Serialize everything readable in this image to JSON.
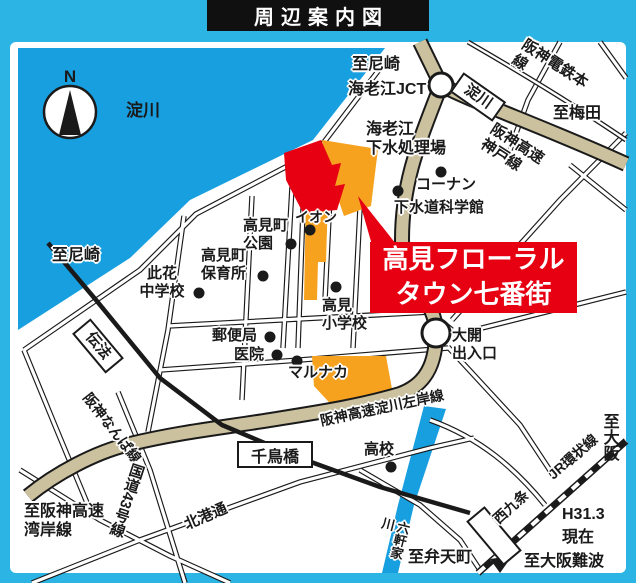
{
  "title": "周辺案内図",
  "colors": {
    "frame": "#2bb4e4",
    "water": "#189fe0",
    "expressway": "#cbc19e",
    "site_red": "#e60012",
    "building_orange": "#f6a21f",
    "ink": "#1a1a1a"
  },
  "compass": {
    "north": "N"
  },
  "rivers": {
    "yodogawa": "淀川",
    "rokkenya": "六軒家川"
  },
  "site": {
    "name": "高見フローラル\nタウン七番街"
  },
  "stations": {
    "yodogawa": "淀川",
    "dempo": "伝法",
    "nishikujo": "西九条"
  },
  "railways": {
    "hanshin_main": "阪神電鉄本線",
    "hanshin_namba": "阪神なんば線",
    "jr_loop": "JR環状線"
  },
  "expressways": {
    "jct": "海老江JCT",
    "kobe_line": "阪神高速\n神戸線",
    "sakishigan_line": "阪神高速淀川左岸線",
    "daikai_exit": "大開\n出入口"
  },
  "roads": {
    "route43": "国道43号線",
    "hokko_dori": "北港通",
    "chidoribashi": "千鳥橋"
  },
  "pois": {
    "ebie_plant": "海老江\n下水処理場",
    "konan": "コーナン",
    "sewer_museum": "下水道科学館",
    "aeon": "イオン",
    "takami_park": "高見町\n公園",
    "takami_nursery": "高見町\n保育所",
    "konohana_jhs": "此花\n中学校",
    "post_office": "郵便局",
    "takami_es": "高見\n小学校",
    "clinic": "医院",
    "marunaka": "マルナカ",
    "high_school": "高校"
  },
  "directions": {
    "to_amagasaki_north": "至尼崎",
    "to_amagasaki_west": "至尼崎",
    "to_umeda": "至梅田",
    "to_osaka": "至大阪",
    "to_wangan": "至阪神高速\n湾岸線",
    "to_bentencho": "至弁天町",
    "to_osaka_namba": "至大阪難波"
  },
  "note": {
    "current": "H31.3\n現在"
  }
}
